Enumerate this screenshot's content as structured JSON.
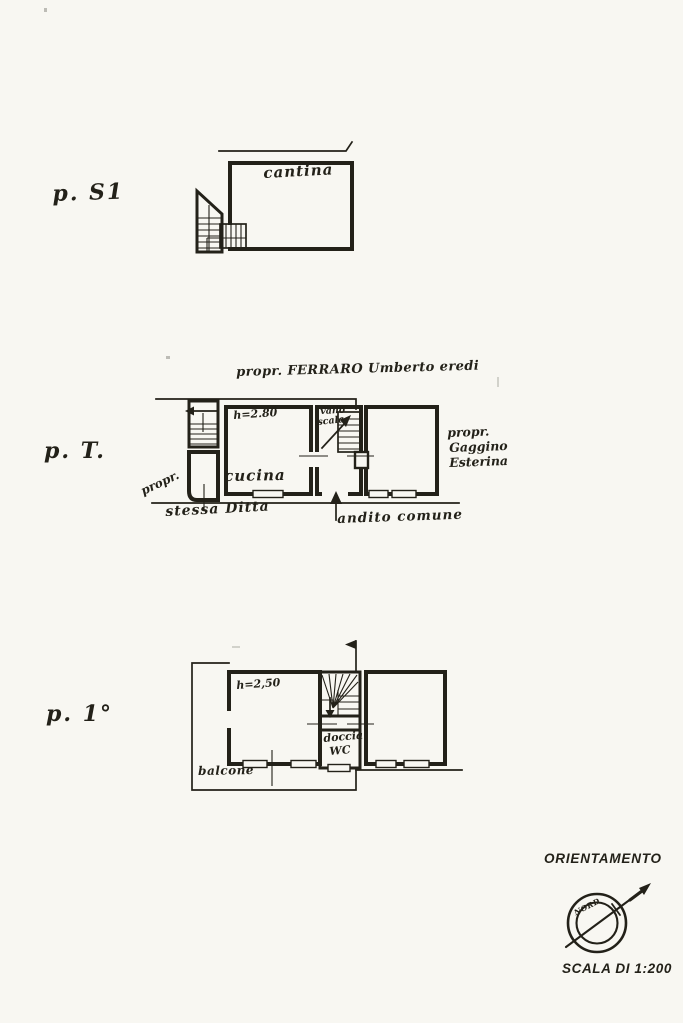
{
  "document": {
    "paper_color": "#f8f7f2",
    "ink_color": "#232119"
  },
  "floors": {
    "s1": {
      "label": "p. S1",
      "room_cantina": "cantina"
    },
    "t": {
      "label": "p. T.",
      "boundary_owner": "propr. FERRARO Umberto eredi",
      "height_note": "h=2.80",
      "room_kitchen": "cucina",
      "stairwell_word1": "vano",
      "stairwell_word2": "scala",
      "owner_left_word1": "propr.",
      "owner_left_word2": "stessa Ditta",
      "neighbor_word1": "propr.",
      "neighbor_word2": "Gaggino",
      "neighbor_word3": "Esterina",
      "common_hall": "andito comune"
    },
    "p1": {
      "label": "p. 1°",
      "height_note": "h=2,50",
      "shower_word1": "doccia",
      "shower_word2": "WC",
      "balcony": "balcone"
    }
  },
  "orientation": {
    "title": "ORIENTAMENTO",
    "north_label": "NORD",
    "scale_note": "SCALA DI 1:200"
  }
}
